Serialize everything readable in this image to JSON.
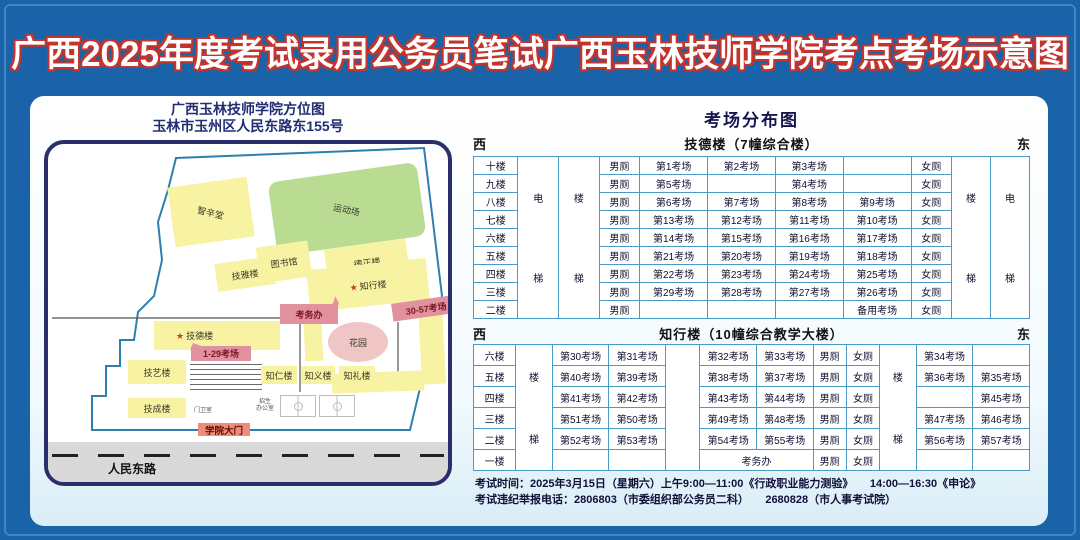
{
  "title": "广西2025年度考试录用公务员笔试广西玉林技师学院考点考场示意图",
  "colors": {
    "frame_blue": "#1b63a9",
    "title_fill": "#ffffff",
    "title_outline": "#c5342c",
    "table_border": "#4a9ac6",
    "navy": "#232d72",
    "building_yellow": "#f8f2a3",
    "field_green": "#b9dc92",
    "pink_label_bg": "#e2919f",
    "pink_label_text": "#7c1322",
    "garden_pink": "#f0c5c6",
    "road_gray": "#d9d9d9",
    "star_red": "#d23c1e"
  },
  "map_panel": {
    "title_line1": "广西玉林技师学院方位图",
    "title_line2": "玉林市玉州区人民东路东155号",
    "road_label": "人民东路",
    "items": [
      {
        "kind": "bldg",
        "label": "智辛堂",
        "x": 123,
        "y": 38,
        "w": 80,
        "h": 60,
        "r": -8,
        "lr": 22
      },
      {
        "kind": "green",
        "label": "运动场",
        "x": 224,
        "y": 28,
        "w": 150,
        "h": 74,
        "r": -8,
        "lr": 20
      },
      {
        "kind": "bldg",
        "label": "技雅楼",
        "x": 168,
        "y": 116,
        "w": 58,
        "h": 28,
        "r": -8
      },
      {
        "kind": "bldg",
        "label": "图书馆",
        "x": 210,
        "y": 100,
        "w": 52,
        "h": 36,
        "r": -8
      },
      {
        "kind": "bldg",
        "label": "德正楼",
        "x": 278,
        "y": 100,
        "w": 82,
        "h": 36,
        "r": -8
      },
      {
        "kind": "bldg",
        "label": "知行楼",
        "star": true,
        "x": 260,
        "y": 120,
        "w": 120,
        "h": 42,
        "r": -6
      },
      {
        "kind": "bldg",
        "label": "",
        "x": 256,
        "y": 162,
        "w": 18,
        "h": 55,
        "r": -3
      },
      {
        "kind": "bldg",
        "label": "",
        "x": 372,
        "y": 160,
        "w": 24,
        "h": 80,
        "r": -3
      },
      {
        "kind": "bldg",
        "label": "",
        "x": 284,
        "y": 228,
        "w": 92,
        "h": 20,
        "r": -2
      },
      {
        "kind": "garden",
        "label": "花园",
        "x": 280,
        "y": 178,
        "w": 60,
        "h": 40
      },
      {
        "kind": "plabel",
        "label": "考务办",
        "x": 232,
        "y": 160,
        "w": 58,
        "h": 20,
        "pointer": "ne"
      },
      {
        "kind": "plabel",
        "label": "30-57考场",
        "x": 344,
        "y": 155,
        "w": 68,
        "h": 18,
        "r": -8
      },
      {
        "kind": "bldg",
        "label": "技德楼",
        "star": true,
        "x": 106,
        "y": 177,
        "w": 126,
        "h": 29,
        "r": 0,
        "la": "left"
      },
      {
        "kind": "plabel",
        "label": "1-29考场",
        "x": 143,
        "y": 202,
        "w": 60,
        "h": 15,
        "pointer": "nw"
      },
      {
        "kind": "bldg",
        "label": "技艺楼",
        "x": 80,
        "y": 216,
        "w": 58,
        "h": 24,
        "r": 0
      },
      {
        "kind": "steps",
        "label": "",
        "x": 142,
        "y": 220,
        "w": 72,
        "h": 30
      },
      {
        "kind": "bldg",
        "label": "知仁楼",
        "x": 213,
        "y": 222,
        "w": 36,
        "h": 18,
        "r": 0
      },
      {
        "kind": "bldg",
        "label": "知义楼",
        "x": 253,
        "y": 222,
        "w": 34,
        "h": 18,
        "r": 0
      },
      {
        "kind": "bldg",
        "label": "知礼楼",
        "x": 291,
        "y": 222,
        "w": 36,
        "h": 18,
        "r": 0
      },
      {
        "kind": "bldg",
        "label": "技成楼",
        "x": 80,
        "y": 254,
        "w": 58,
        "h": 20,
        "r": 0
      },
      {
        "kind": "tiny",
        "label": "门卫室",
        "x": 140,
        "y": 262,
        "w": 30,
        "h": 10
      },
      {
        "kind": "tiny",
        "label": "招生\n办公室",
        "x": 200,
        "y": 254,
        "w": 34,
        "h": 16
      },
      {
        "kind": "court",
        "label": "",
        "x": 232,
        "y": 251,
        "w": 36,
        "h": 22
      },
      {
        "kind": "court",
        "label": "",
        "x": 271,
        "y": 251,
        "w": 36,
        "h": 22
      },
      {
        "kind": "gate",
        "label": "学院大门",
        "x": 150,
        "y": 279,
        "w": 52,
        "h": 13
      }
    ]
  },
  "distribution": {
    "title": "考场分布图",
    "west": "西",
    "east": "东",
    "male": "男厕",
    "female": "女厕",
    "elevator": [
      "电",
      "梯"
    ],
    "stairs": [
      "楼",
      "梯"
    ],
    "table1": {
      "building": "技德楼（7幢综合楼）",
      "rows": [
        {
          "floor": "十楼",
          "rooms": [
            "第1考场",
            "第2考场",
            "第3考场",
            ""
          ]
        },
        {
          "floor": "九楼",
          "rooms": [
            "第5考场",
            "",
            "第4考场",
            ""
          ]
        },
        {
          "floor": "八楼",
          "rooms": [
            "第6考场",
            "第7考场",
            "第8考场",
            "第9考场"
          ]
        },
        {
          "floor": "七楼",
          "rooms": [
            "第13考场",
            "第12考场",
            "第11考场",
            "第10考场"
          ]
        },
        {
          "floor": "六楼",
          "rooms": [
            "第14考场",
            "第15考场",
            "第16考场",
            "第17考场"
          ]
        },
        {
          "floor": "五楼",
          "rooms": [
            "第21考场",
            "第20考场",
            "第19考场",
            "第18考场"
          ]
        },
        {
          "floor": "四楼",
          "rooms": [
            "第22考场",
            "第23考场",
            "第24考场",
            "第25考场"
          ]
        },
        {
          "floor": "三楼",
          "rooms": [
            "第29考场",
            "第28考场",
            "第27考场",
            "第26考场"
          ]
        },
        {
          "floor": "二楼",
          "rooms": [
            "",
            "",
            "",
            "备用考场"
          ]
        }
      ]
    },
    "table2": {
      "building": "知行楼（10幢综合教学大楼）",
      "office": "考务办",
      "rows": [
        {
          "floor": "六楼",
          "west_rooms": [
            "第30考场",
            "第31考场"
          ],
          "mid_rooms": [
            "第32考场",
            "第33考场"
          ],
          "east_rooms": [
            "第34考场",
            ""
          ]
        },
        {
          "floor": "五楼",
          "west_rooms": [
            "第40考场",
            "第39考场"
          ],
          "mid_rooms": [
            "第38考场",
            "第37考场"
          ],
          "east_rooms": [
            "第36考场",
            "第35考场"
          ]
        },
        {
          "floor": "四楼",
          "west_rooms": [
            "第41考场",
            "第42考场"
          ],
          "mid_rooms": [
            "第43考场",
            "第44考场"
          ],
          "east_rooms": [
            "",
            "第45考场"
          ]
        },
        {
          "floor": "三楼",
          "west_rooms": [
            "第51考场",
            "第50考场"
          ],
          "mid_rooms": [
            "第49考场",
            "第48考场"
          ],
          "east_rooms": [
            "第47考场",
            "第46考场"
          ]
        },
        {
          "floor": "二楼",
          "west_rooms": [
            "第52考场",
            "第53考场"
          ],
          "mid_rooms": [
            "第54考场",
            "第55考场"
          ],
          "east_rooms": [
            "第56考场",
            "第57考场"
          ]
        },
        {
          "floor": "一楼",
          "west_rooms": [
            "",
            ""
          ],
          "office_span": true,
          "east_rooms": [
            "",
            ""
          ]
        }
      ]
    },
    "footer_line1": "考试时间：2025年3月15日（星期六）上午9:00—11:00《行政职业能力测验》　　14:00—16:30《申论》",
    "footer_line2": "考试违纪举报电话：2806803（市委组织部公务员二科）　　2680828（市人事考试院）"
  }
}
